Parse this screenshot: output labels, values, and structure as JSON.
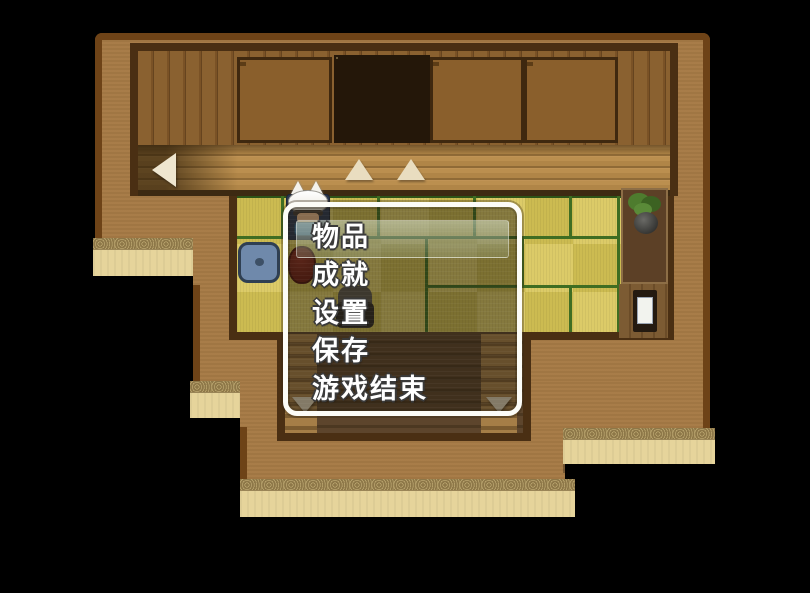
{
  "menu": {
    "items": [
      {
        "label": "物品"
      },
      {
        "label": "成就"
      },
      {
        "label": "设置"
      },
      {
        "label": "保存"
      },
      {
        "label": "游戏结束"
      }
    ],
    "selected_index": 0,
    "selected_label": "物品"
  },
  "map": {
    "arrows": [
      {
        "direction": "left"
      },
      {
        "direction": "up"
      },
      {
        "direction": "up"
      },
      {
        "direction": "down"
      },
      {
        "direction": "down"
      }
    ],
    "objects": [
      "wooden-wall",
      "closet-cabinet",
      "shoji-door",
      "wood-walkway",
      "tatami-floor",
      "blue-cushion",
      "round-table",
      "bonsai-plant",
      "shrine-cabinet",
      "entry-steps",
      "stone-path"
    ],
    "characters": [
      {
        "name": "player-cat-hood"
      },
      {
        "name": "npc-gray-hair"
      }
    ]
  },
  "colors": {
    "background": "#000000",
    "exterior_wall": "#a67a45",
    "wall_border": "#6e4317",
    "tatami": "#d8c65e",
    "tatami_line": "#3f6d22",
    "walkway": "#b08547",
    "stone_path": "#e6d49b",
    "window_border": "#fcfcf7",
    "window_fill": "rgba(30,24,14,0.46)",
    "selection_highlight": "rgba(225,240,220,0.5)",
    "menu_text": "#ffffff"
  }
}
